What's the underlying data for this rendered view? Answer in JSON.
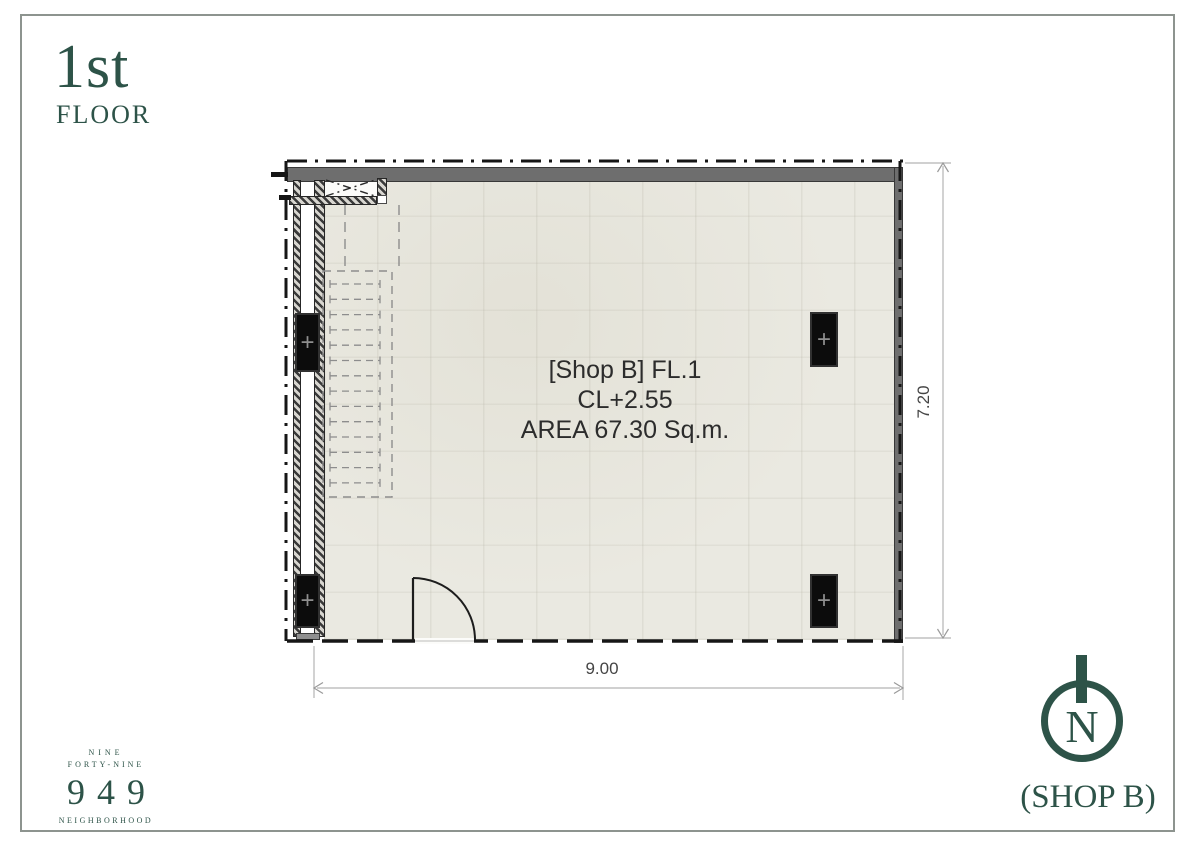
{
  "title": {
    "floor": "1st",
    "floor_sub": "FLOOR"
  },
  "plan": {
    "unit": "[Shop B] FL.1",
    "ceiling": "CL+2.55",
    "area": "AREA 67.30 Sq.m.",
    "width_dim": "9.00",
    "height_dim": "7.20",
    "column_marker": "+"
  },
  "compass": {
    "north": "N"
  },
  "shop_caption": "(SHOP B)",
  "logo": {
    "top1": "NINE",
    "top2": "FORTY-NINE",
    "number": "949",
    "bottom": "NEIGHBORHOOD"
  },
  "colors": {
    "accent_teal": "#2d5348",
    "wall_gray": "#6e6e6e",
    "floor_fill": "#eae9e1",
    "boundary_line": "#161616",
    "dimension_line": "#b5b5b5",
    "stair_dash": "#8d8d8d"
  }
}
